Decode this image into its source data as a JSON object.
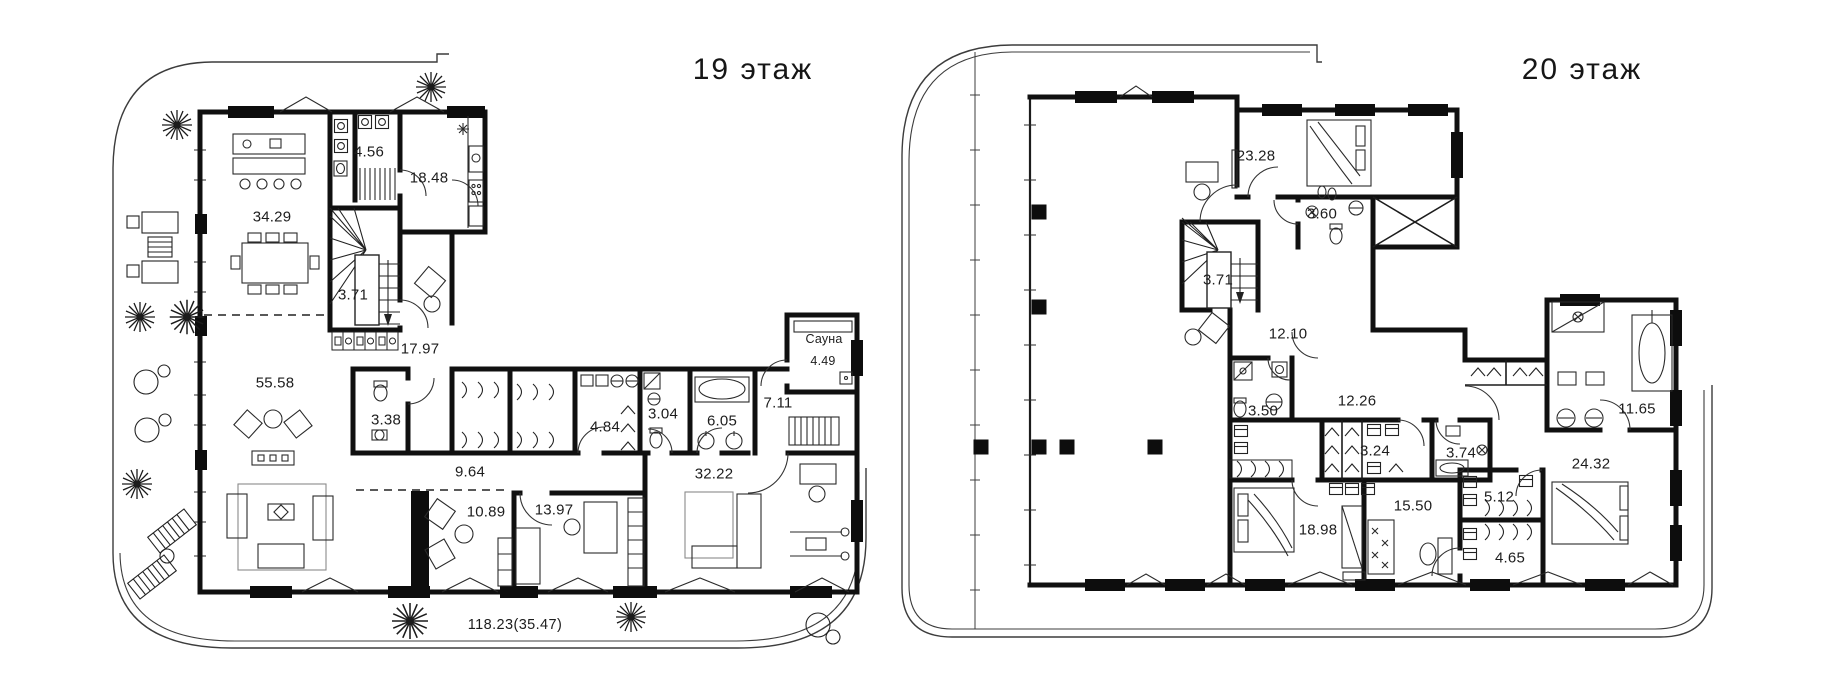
{
  "page": {
    "colors": {
      "background": "#ffffff",
      "wall": "#101010",
      "thin_line": "#3c3c3c",
      "text": "#1d1d1d"
    }
  },
  "plans": [
    {
      "id": "floor-19",
      "title": "19 этаж",
      "terrace_label": "118.23(35.47)",
      "rooms": [
        {
          "name": "kitchen-dining",
          "area": "34.29"
        },
        {
          "name": "bathroom-top",
          "area": "4.56"
        },
        {
          "name": "kitchen",
          "area": "18.48"
        },
        {
          "name": "stairs",
          "area": "3.71"
        },
        {
          "name": "hall",
          "area": "17.97"
        },
        {
          "name": "living-room",
          "area": "55.58"
        },
        {
          "name": "wc",
          "area": "3.38"
        },
        {
          "name": "corridor",
          "area": "9.64"
        },
        {
          "name": "laundry-wardrobe",
          "area": "4.84"
        },
        {
          "name": "shower-room",
          "area": "3.04"
        },
        {
          "name": "bathroom",
          "area": "6.05"
        },
        {
          "name": "rest-room",
          "area": "7.11"
        },
        {
          "name": "sauna",
          "label": "Сауна",
          "area": "4.49"
        },
        {
          "name": "bedroom",
          "area": "32.22"
        },
        {
          "name": "cabinet-1",
          "area": "10.89"
        },
        {
          "name": "cabinet-2",
          "area": "13.97"
        }
      ]
    },
    {
      "id": "floor-20",
      "title": "20 этаж",
      "rooms": [
        {
          "name": "bedroom-1",
          "area": "23.28"
        },
        {
          "name": "bathroom-1",
          "area": "3.60"
        },
        {
          "name": "stairs",
          "area": "3.71"
        },
        {
          "name": "hall",
          "area": "12.10"
        },
        {
          "name": "bathroom-2",
          "area": "3.50"
        },
        {
          "name": "corridor",
          "area": "12.26"
        },
        {
          "name": "wardrobe-1",
          "area": "3.24"
        },
        {
          "name": "bathroom-3",
          "area": "3.74"
        },
        {
          "name": "master-bathroom",
          "area": "11.65"
        },
        {
          "name": "master-bedroom",
          "area": "24.32"
        },
        {
          "name": "bedroom-2",
          "area": "18.98"
        },
        {
          "name": "hall-2",
          "area": "15.50"
        },
        {
          "name": "wardrobe-2",
          "area": "5.12"
        },
        {
          "name": "wardrobe-3",
          "area": "4.65"
        }
      ]
    }
  ]
}
